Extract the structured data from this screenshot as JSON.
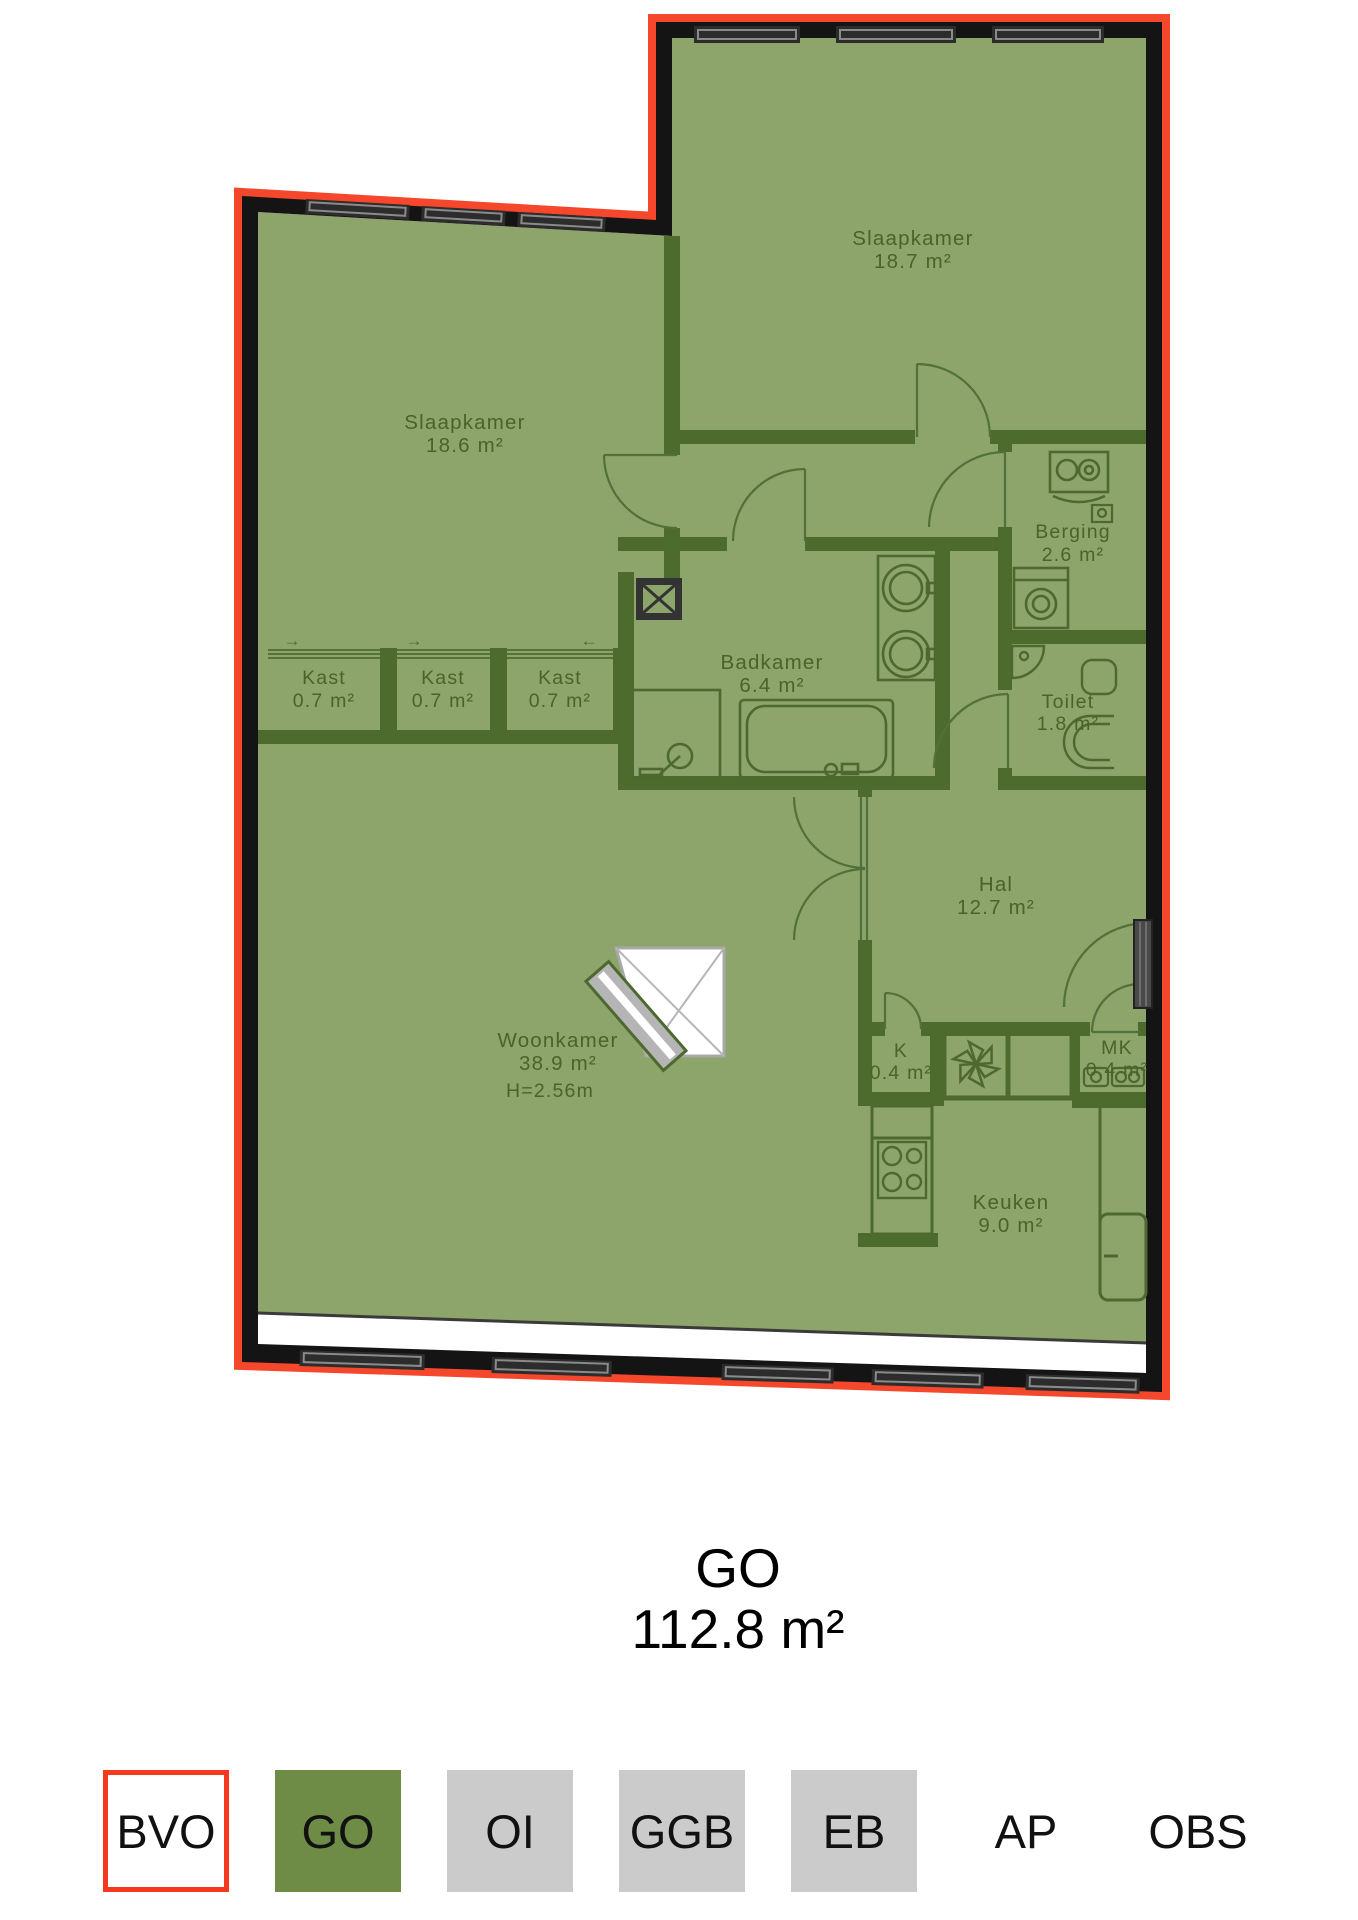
{
  "plan": {
    "colors": {
      "outline_red": "#f4472b",
      "exterior_wall": "#141414",
      "interior_wall": "#4e6b2e",
      "floor_green": "#8da46b",
      "label_text": "#4a6327",
      "window_gray": "#2c2c2c"
    },
    "rooms": [
      {
        "name": "Slaapkamer",
        "area": "18.7 m²"
      },
      {
        "name": "Slaapkamer",
        "area": "18.6 m²"
      },
      {
        "name": "Berging",
        "area": "2.6 m²"
      },
      {
        "name": "Kast",
        "area": "0.7 m²"
      },
      {
        "name": "Kast",
        "area": "0.7 m²"
      },
      {
        "name": "Kast",
        "area": "0.7 m²"
      },
      {
        "name": "Badkamer",
        "area": "6.4 m²"
      },
      {
        "name": "Toilet",
        "area": "1.8 m²"
      },
      {
        "name": "Hal",
        "area": "12.7 m²"
      },
      {
        "name": "Woonkamer",
        "area": "38.9 m²",
        "ceiling_height": "H=2.56m"
      },
      {
        "name": "K",
        "area": "0.4 m²"
      },
      {
        "name": "MK",
        "area": "0.4 m²"
      },
      {
        "name": "Keuken",
        "area": "9.0 m²"
      }
    ],
    "sliding_door_arrows": [
      "→",
      "→",
      "←"
    ],
    "fixture_icons": [
      "window",
      "swing-door",
      "sliding-door",
      "bathtub",
      "shower-head",
      "double-washbasin",
      "wall-hung-toilet",
      "corner-basin",
      "washing-machine",
      "boiler-unit",
      "ventilation-fan-icon",
      "electric-meter-icon",
      "gas-stove",
      "fridge",
      "fireplace",
      "shaft-x"
    ]
  },
  "summary": {
    "label": "GO",
    "value": "112.8 m²"
  },
  "legend": {
    "items": [
      {
        "label": "BVO",
        "style": "outlined"
      },
      {
        "label": "GO",
        "style": "green"
      },
      {
        "label": "OI",
        "style": "gray"
      },
      {
        "label": "GGB",
        "style": "gray"
      },
      {
        "label": "EB",
        "style": "gray"
      },
      {
        "label": "AP",
        "style": "plain"
      },
      {
        "label": "OBS",
        "style": "plain"
      }
    ]
  }
}
